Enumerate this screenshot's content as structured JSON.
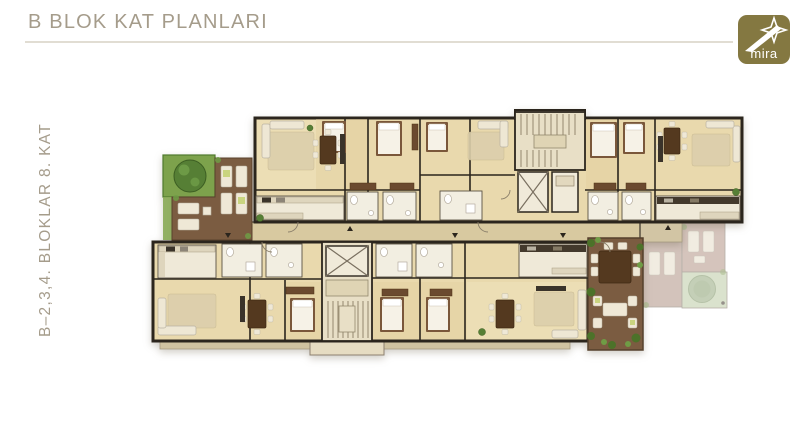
{
  "slide": {
    "title": "B BLOK KAT PLANLARI",
    "side_label": "B–2,3,4. BLOKLAR 8. KAT",
    "background_color": "#ffffff",
    "heading_color": "#a59c8b",
    "divider_color": "#e1ddd3"
  },
  "logo": {
    "text": "mira",
    "background_color": "#847841",
    "text_color": "#ffffff",
    "icon": "star-swoosh-icon"
  },
  "floor_plan": {
    "kind": "architectural floor plan, top-down view, no text labels",
    "palette": {
      "walls": "#2b251d",
      "wood_floor": "#e9d9ad",
      "corridor": "#d8c9a0",
      "wet_rooms": "#f2eee1",
      "terrace_wood": "#7b5c41",
      "garden_green": "#7da24c",
      "ghost_block": "#c3aca1",
      "ghost_garden": "#cdd7ba"
    },
    "elements": [
      "left garden square with tree and lounge terrace",
      "two apartment wings along a central corridor",
      "upper stair and elevator core",
      "lower stair and elevator core",
      "right terrace with dining table and seating",
      "faded neighbouring terrace and garden at far right",
      "balcony strips along lower edge"
    ]
  }
}
